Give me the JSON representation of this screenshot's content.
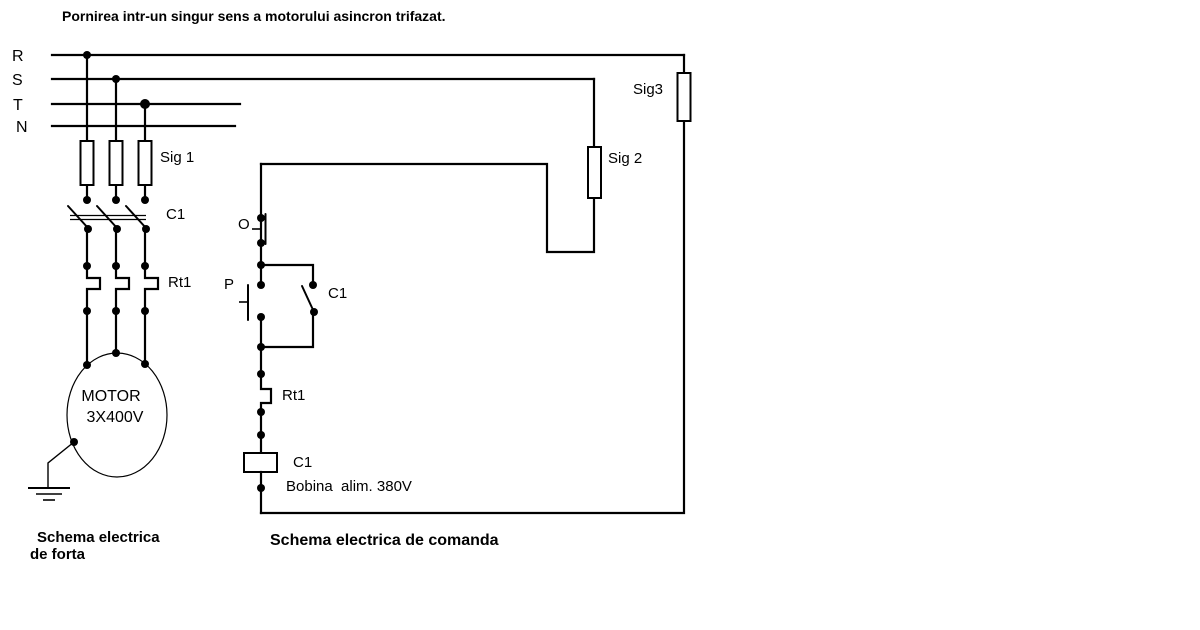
{
  "title": "Pornirea intr-un singur sens a motorului asincron trifazat.",
  "colors": {
    "background": "#ffffff",
    "ink": "#000000"
  },
  "power": {
    "phases": [
      "R",
      "S",
      "T",
      "N"
    ],
    "fuse_label": "Sig 1",
    "contactor_label": "C1",
    "relay_label": "Rt1",
    "motor_name": "MOTOR",
    "motor_voltage": "3X400V",
    "caption_line1": "Schema electrica",
    "caption_line2": "de forta"
  },
  "control": {
    "fuse2_label": "Sig 2",
    "fuse3_label": "Sig3",
    "stop_label": "O",
    "start_label": "P",
    "seal_contact_label": "C1",
    "relay_label": "Rt1",
    "coil_label": "C1",
    "coil_caption": "Bobina  alim. 380V",
    "caption": "Schema electrica de comanda"
  }
}
